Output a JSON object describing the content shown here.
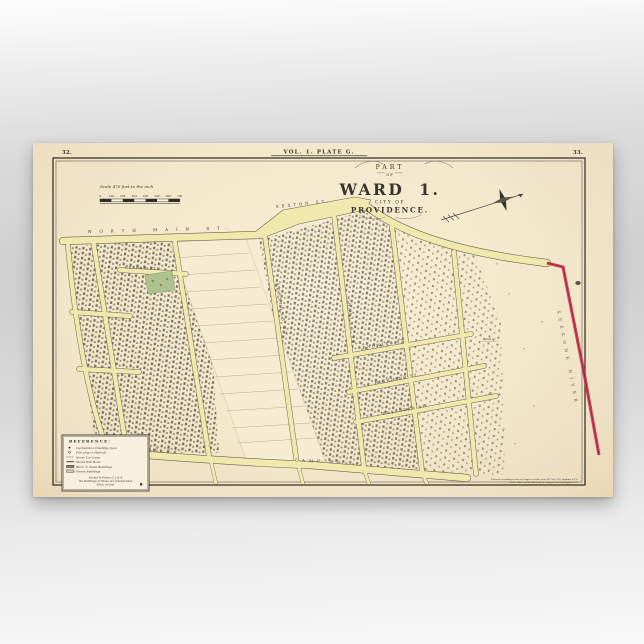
{
  "header": {
    "page_left": "32.",
    "plate": "VOL. 1. PLATE G.",
    "page_right": "33."
  },
  "title": {
    "part": "PART",
    "of": "OF",
    "ward": "WARD 1.",
    "city_of": "CITY OF",
    "providence": "PROVIDENCE."
  },
  "scale": {
    "label": "Scale 470 feet to the inch",
    "ticks": [
      "0",
      "100",
      "200",
      "300",
      "400",
      "500",
      "600",
      "700"
    ]
  },
  "streets": {
    "north_main": "NORTH MAIN ST.",
    "sexton": "SEXTON ST.",
    "graham": "GRAHAM ST.",
    "sessions": "SESSIONS ST.",
    "charles": "CHARLES ST.",
    "knowles": "KNOWLES ST.",
    "highland": "HIGHLAND ST.",
    "rolander": "ROLANDER ST.",
    "camp_west": "CAMP ST.",
    "camp_east": "CAMP ST."
  },
  "annotations": {
    "river": "SEEKONK RIVER",
    "parcel": "Lands of"
  },
  "reference": {
    "title": "REFERENCE:",
    "items": [
      {
        "label": "represents a Dwelling place"
      },
      {
        "label": "Fire plug or Hydrant"
      },
      {
        "label": "Horse Car Lines"
      },
      {
        "label": "Steam Rail Road"
      },
      {
        "label": "Brick or Stone Buildings"
      },
      {
        "label": "Frame Buildings"
      }
    ],
    "note": [
      "Except in Plates G, J & K",
      "the Buildings of Stone are marked thus",
      "Brick in blue"
    ]
  },
  "credit": {
    "line1": "Entered according to Act of Congress in the year 1875 by G.M. Hopkins & Co.",
    "line2": "in the Office of the Librarian of Congress at Washington, D.C."
  },
  "colors": {
    "paper": "#f3e8ca",
    "street_yellow": "#f1e8ad",
    "boundary_red": "#c5314e",
    "park_green": "#aec28f",
    "ink": "#3a342c"
  }
}
